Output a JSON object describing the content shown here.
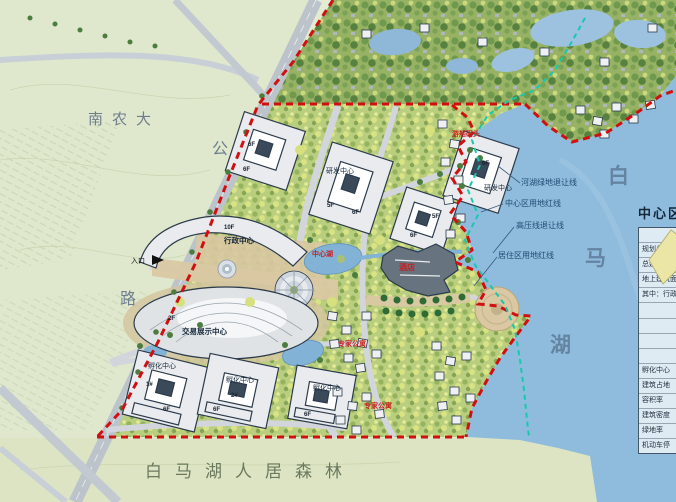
{
  "area_labels": {
    "university": "南农大",
    "road_char_top": "公",
    "road_char_bottom": "路",
    "entrance": "入口",
    "lake_char_1": "白",
    "lake_char_2": "马",
    "lake_char_3": "湖",
    "forest_band": "白马湖人居森林"
  },
  "setback_labels": {
    "river_green": "河湖绿地退让线",
    "center_redline": "中心区用地红线",
    "high_voltage": "高压线退让线",
    "residential_redline": "居住区用地红线"
  },
  "buildings": {
    "admin": "行政中心",
    "expo": "交易展示中心",
    "rnd": "研发中心",
    "incubator": "孵化中心",
    "hotel": "酒店",
    "expert_apartment": "专家公寓",
    "dock": "游船码头",
    "central_lake": "中心湖",
    "floors": {
      "f10": "10F",
      "f6": "6F",
      "f5": "5F",
      "f2": "2F",
      "u1": "1#",
      "u2": "2#"
    }
  },
  "legend_table": {
    "title": "中心区",
    "rows": [
      "名称",
      "规划总用地",
      "总建筑面积",
      "地上建筑面积",
      "其中：行政",
      "",
      "",
      "",
      "",
      "孵化中心",
      "建筑占地",
      "容积率",
      "建筑密度",
      "绿地率",
      "机动车停"
    ]
  },
  "colors": {
    "boundary_red": "#d01010",
    "setback_cyan": "#16c9ae",
    "lake_blue": "#8fbcdc",
    "field_green": "#e3ebd3",
    "forest_green": "#97b264",
    "red_label": "#c42020",
    "road_gray": "#bcc3cb"
  }
}
